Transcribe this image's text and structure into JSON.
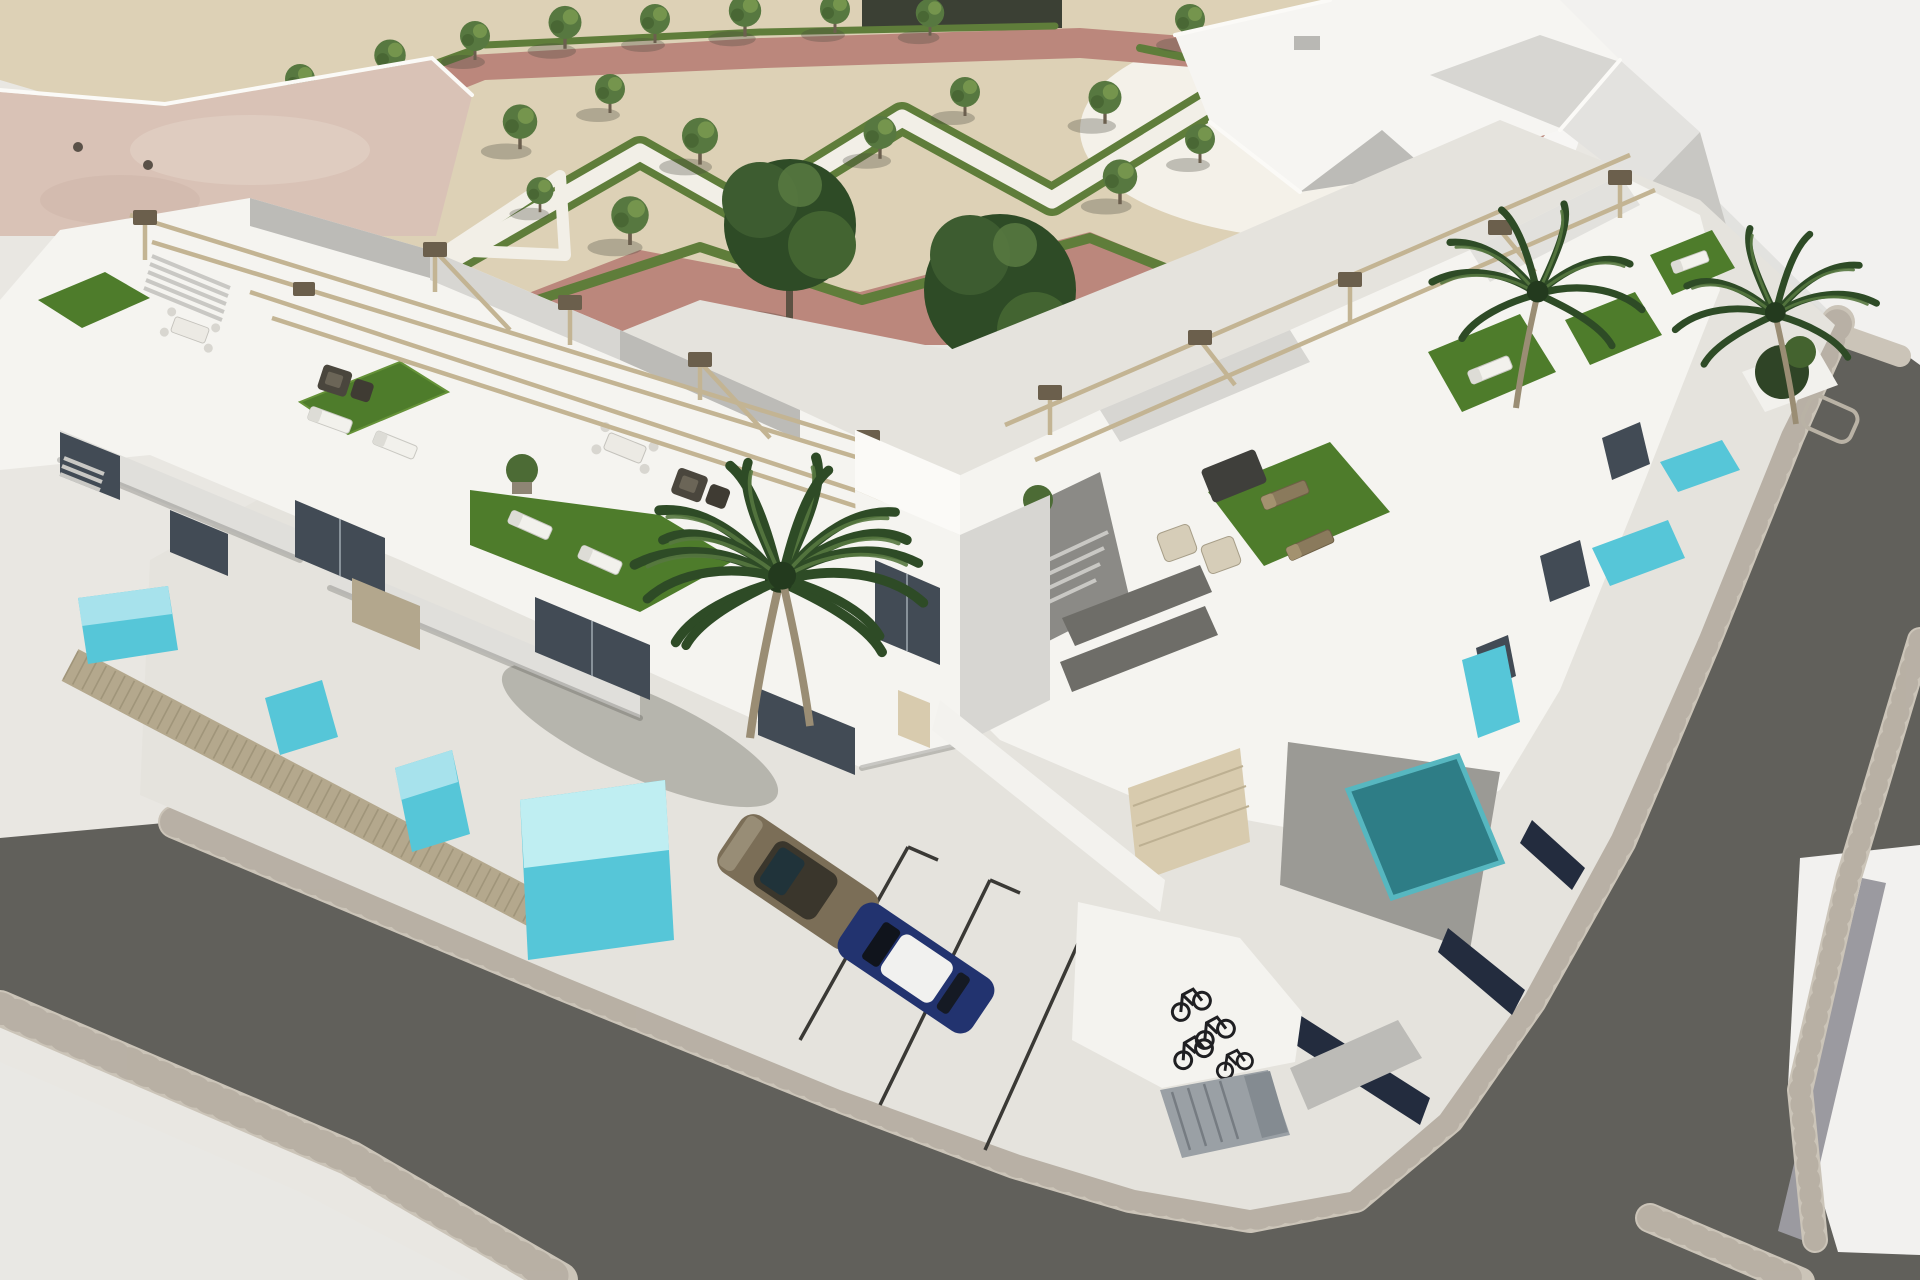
{
  "meta": {
    "kind": "architectural-3d-aerial-render",
    "subject": "modern white townhouse development on a street corner with central park"
  },
  "palette": {
    "base": "#e9e7e2",
    "sand": "#ddd1b6",
    "pinkPath": "#bb877c",
    "pinkLight": "#c9998b",
    "hedge": "#5f7d3a",
    "hedgeDark": "#44602c",
    "walkway": "#f2efe7",
    "treeCanopy": "#577840",
    "treeHighlight": "#7a9a50",
    "treeDark": "#2e4b26",
    "trunk": "#6b5f4e",
    "wall": "#f5f4f0",
    "facetLight": "#d7d6d2",
    "facetMid": "#bcbbb7",
    "facetDark": "#9d9c98",
    "glass": "#424b55",
    "glassDark": "#272c33",
    "turf": "#4e7c2b",
    "turfLight": "#659238",
    "pergola": "#c3b493",
    "pergolaCap": "#6b5f4c",
    "fence": "#b4a88d",
    "poolLight": "#a7e2ec",
    "poolMid": "#56c6d8",
    "poolDeep": "#2e7d86",
    "asphalt": "#61605b",
    "cobble": "#cbc4b8",
    "cobbleLine": "#a9a195",
    "concrete": "#e5e3dd",
    "concreteBright": "#e9e8e4",
    "pavementRight": "#f2f1ef",
    "stripe": "#9b9aa0",
    "navy": "#232c3e",
    "roofPink": "#d9c2b6",
    "terraceGray": "#9b9a95",
    "garage": "#d8cbae",
    "carOlive": "#7b6e57",
    "carOliveCabin": "#3a362c",
    "carBlue": "#22336f",
    "carRoofWhite": "#f1f1ef",
    "bike": "#1f1f22",
    "shed": "#9aa0a5",
    "shedLine": "#767c82",
    "marking": "#3a3935"
  },
  "scene": {
    "park": {
      "ground": "tan gravel",
      "paths": "dusty-rose walkways around edges, white gravel walkways inside",
      "hedges": "clipped zigzag parterre hedges",
      "small_trees": 22,
      "large_trees": 2
    },
    "buildings": {
      "rows": 2,
      "style": "white modern two-storey townhouses",
      "rooftop_features": "artificial turf terraces, sun loungers, rattan sofa sets, dining sets, beige pergola rails",
      "front_features": "private plunge pools, wood-slat privacy fences, balconies, garage door",
      "existing_building": "large flat pink-beige roof at top-left",
      "white_building_top_right": "angular white roof planes"
    },
    "streets": {
      "surface": "dark asphalt",
      "sidewalks": "light paver bands with rounded street corner",
      "extras": "far-right white pavement with grey stripe"
    },
    "vehicles": {
      "cars": [
        "olive-brown hatchback",
        "dark-blue car with white roof"
      ],
      "bicycles": 4
    },
    "vegetation": {
      "palm_clusters": 3,
      "planter_bush": 1
    }
  }
}
